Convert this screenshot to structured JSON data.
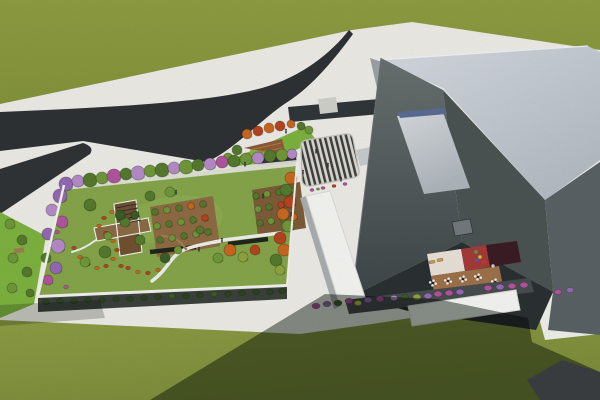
{
  "scene": {
    "type": "3d-architectural-aerial-rendering",
    "subject": "campus with rooftop garden podium, angular gray building, forked road, striped entry plaza and lawns"
  },
  "palette": {
    "ground": "#eceae5",
    "field_top": "#8d9c41",
    "field_top_dark": "#83923a",
    "field_bottom": "#96a449",
    "field_bottom_dark": "#7c8d3b",
    "road": "#2d3133",
    "road_branch": "#2f3335",
    "access_road": "#303537",
    "crossing": "#cfcfca",
    "garden_lawn": "#84a44a",
    "garden_lawn_light": "#93b156",
    "garden_rim": "#f1f1ec",
    "pergola_band": "#e6e6e0",
    "podium_wall": "#39413a",
    "orchard_ground": "#8d6a43",
    "orchard_ground2": "#7c5c38",
    "bench": "#20261c",
    "path_white": "#eceee8",
    "path_brown": "#a07b50",
    "pavilion_deck": "#8a6a45",
    "pavilion_deck_dark": "#6f5130",
    "pavilion_frame": "#f2f2ee",
    "trellis": "#2e2d2a",
    "plaza_light": "#d8d7d1",
    "plaza_dark": "#3f403c",
    "plaza_curb": "#c2c2bc",
    "lawn_strip": "#7cb13f",
    "deck_triangle": "#8a5a36",
    "deck_triangle_light": "#a87547",
    "shelter_roof": "#37373a",
    "shelter_trim": "#e8e8e6",
    "roof_light_1": "#d3d9df",
    "roof_light_2": "#b2b9c0",
    "wall_lit": "#9aa1a6",
    "wall_lit2": "#a8adaf",
    "steps": "#c6cacc",
    "tower_face_1a": "#68706f",
    "tower_face_1b": "#3e4548",
    "tower_face_2": "#4b5352",
    "tower_face_3": "#596164",
    "tower_base": "#2a2f31",
    "skylight_1": "#d5d9dd",
    "skylight_2": "#adb4ba",
    "skylight_strip": "#5a6a94",
    "vent": "#72787c",
    "white_roof": "#f3f3f0",
    "white_roof_edge": "#d9d9d5",
    "court_floor_cream": "#e7e0d6",
    "court_floor_red": "#a33a38",
    "court_play": "#3a1d24",
    "court_deck": "#9c7049",
    "lounger": "#c89a58",
    "table_seat": "#f0f0ee",
    "table_center": "#222222",
    "walk_dark": "#474c4e",
    "pavement_dark": "#3a3e40",
    "shadow": "#263129",
    "people": "#2e2e2e",
    "foliage": {
      "g1": "#3c5c26",
      "g2": "#55792e",
      "g3": "#6f9739",
      "g4": "#8ea33e",
      "dk": "#2c421f",
      "pu": "#9468b4",
      "pu2": "#b48ac6",
      "mg": "#b0549e",
      "or": "#c8661f",
      "rd": "#b6431f",
      "yl": "#b9c24a"
    }
  },
  "vegetation": {
    "garden_border": [
      [
        66,
        184,
        7,
        "pu"
      ],
      [
        78,
        181,
        6,
        "pu2"
      ],
      [
        90,
        180,
        7,
        "g2"
      ],
      [
        102,
        178,
        6,
        "g3"
      ],
      [
        114,
        176,
        7,
        "mg"
      ],
      [
        126,
        174,
        6,
        "g2"
      ],
      [
        138,
        173,
        7,
        "pu2"
      ],
      [
        150,
        171,
        6,
        "g3"
      ],
      [
        162,
        170,
        7,
        "g2"
      ],
      [
        174,
        168,
        6,
        "pu2"
      ],
      [
        186,
        167,
        7,
        "g3"
      ],
      [
        198,
        165,
        6,
        "g2"
      ],
      [
        210,
        164,
        6,
        "pu2"
      ],
      [
        222,
        162,
        6,
        "mg"
      ],
      [
        234,
        161,
        6,
        "g2"
      ],
      [
        246,
        159,
        6,
        "g3"
      ],
      [
        258,
        158,
        6,
        "pu2"
      ],
      [
        270,
        156,
        6,
        "g2"
      ],
      [
        282,
        155,
        6,
        "g3"
      ],
      [
        292,
        154,
        5,
        "pu2"
      ],
      [
        291,
        178,
        6,
        "or"
      ],
      [
        286,
        190,
        6,
        "g2"
      ],
      [
        290,
        202,
        6,
        "rd"
      ],
      [
        283,
        214,
        6,
        "or"
      ],
      [
        288,
        226,
        6,
        "g3"
      ],
      [
        280,
        238,
        6,
        "rd"
      ],
      [
        284,
        250,
        6,
        "or"
      ],
      [
        276,
        260,
        6,
        "g2"
      ],
      [
        280,
        270,
        5,
        "g4"
      ],
      [
        60,
        196,
        7,
        "pu"
      ],
      [
        52,
        210,
        6,
        "pu2"
      ],
      [
        62,
        222,
        6,
        "mg"
      ],
      [
        48,
        234,
        6,
        "pu"
      ],
      [
        58,
        246,
        7,
        "pu2"
      ],
      [
        46,
        258,
        5,
        "g2"
      ],
      [
        56,
        268,
        6,
        "pu"
      ],
      [
        48,
        280,
        5,
        "mg"
      ]
    ],
    "garden_interior": [
      [
        150,
        196,
        5,
        "g2"
      ],
      [
        170,
        192,
        5,
        "g3"
      ],
      [
        90,
        205,
        6,
        "g2"
      ],
      [
        105,
        252,
        6,
        "g2"
      ],
      [
        85,
        262,
        5,
        "g3"
      ],
      [
        120,
        215,
        5,
        "g1"
      ],
      [
        140,
        240,
        5,
        "g2"
      ],
      [
        230,
        250,
        6,
        "or"
      ],
      [
        243,
        257,
        5,
        "g4"
      ],
      [
        218,
        258,
        5,
        "g3"
      ],
      [
        255,
        250,
        5,
        "rd"
      ],
      [
        200,
        230,
        4,
        "g2"
      ],
      [
        165,
        258,
        5,
        "g1"
      ],
      [
        178,
        250,
        4,
        "g3"
      ]
    ],
    "orchard1": [
      [
        155,
        212,
        3.4,
        "g2"
      ],
      [
        167,
        210,
        3.4,
        "g3"
      ],
      [
        179,
        208,
        3.4,
        "g2"
      ],
      [
        191,
        206,
        3.4,
        "or"
      ],
      [
        203,
        204,
        3.4,
        "g2"
      ],
      [
        157,
        226,
        3.4,
        "g3"
      ],
      [
        169,
        224,
        3.4,
        "g2"
      ],
      [
        181,
        222,
        3.4,
        "g3"
      ],
      [
        193,
        220,
        3.4,
        "g2"
      ],
      [
        205,
        218,
        3.4,
        "rd"
      ],
      [
        160,
        240,
        3.4,
        "g2"
      ],
      [
        172,
        238,
        3.4,
        "g3"
      ],
      [
        184,
        236,
        3.4,
        "g2"
      ],
      [
        196,
        234,
        3.4,
        "g3"
      ],
      [
        208,
        232,
        3.4,
        "g2"
      ]
    ],
    "orchard2": [
      [
        256,
        196,
        3.3,
        "g2"
      ],
      [
        267,
        194,
        3.3,
        "g3"
      ],
      [
        279,
        192,
        3.3,
        "g2"
      ],
      [
        290,
        190,
        3.3,
        "g3"
      ],
      [
        258,
        209,
        3.3,
        "g3"
      ],
      [
        269,
        207,
        3.3,
        "g2"
      ],
      [
        281,
        205,
        3.3,
        "rd"
      ],
      [
        292,
        203,
        3.3,
        "g2"
      ],
      [
        260,
        223,
        3.3,
        "g2"
      ],
      [
        271,
        221,
        3.3,
        "g3"
      ],
      [
        283,
        219,
        3.3,
        "g2"
      ],
      [
        294,
        217,
        3.3,
        "or"
      ]
    ],
    "street_trees": [
      [
        10,
        224,
        5,
        "g3"
      ],
      [
        22,
        240,
        5,
        "g2"
      ],
      [
        13,
        258,
        5,
        "g3"
      ],
      [
        27,
        272,
        5,
        "g2"
      ],
      [
        12,
        288,
        5,
        "g3"
      ],
      [
        30,
        293,
        4,
        "g2"
      ]
    ],
    "orange_row": [
      [
        247,
        134,
        5,
        "or"
      ],
      [
        258,
        131,
        5,
        "rd"
      ],
      [
        269,
        128,
        5,
        "or"
      ],
      [
        280,
        126,
        5,
        "rd"
      ],
      [
        291,
        124,
        4,
        "or"
      ],
      [
        301,
        126,
        4,
        "g2"
      ],
      [
        309,
        130,
        4,
        "g3"
      ],
      [
        237,
        150,
        5,
        "g2"
      ],
      [
        228,
        158,
        5,
        "g3"
      ]
    ],
    "hedge": [
      [
        46,
        302,
        3.4,
        "dk"
      ],
      [
        60,
        301,
        3.4,
        "dk"
      ],
      [
        74,
        301,
        3.4,
        "dk"
      ],
      [
        88,
        300,
        3.4,
        "dk"
      ],
      [
        102,
        300,
        3.4,
        "dk"
      ],
      [
        116,
        299,
        3.4,
        "dk"
      ],
      [
        130,
        299,
        3.4,
        "dk"
      ],
      [
        144,
        298,
        3.4,
        "dk"
      ],
      [
        158,
        297,
        3.4,
        "dk"
      ],
      [
        172,
        296,
        3.4,
        "g1"
      ],
      [
        186,
        296,
        3.4,
        "dk"
      ],
      [
        200,
        295,
        3.4,
        "dk"
      ],
      [
        214,
        294,
        3.4,
        "g1"
      ],
      [
        228,
        294,
        3.4,
        "dk"
      ],
      [
        242,
        293,
        3.4,
        "dk"
      ],
      [
        256,
        292,
        3.4,
        "dk"
      ],
      [
        270,
        292,
        3.4,
        "dk"
      ],
      [
        282,
        291,
        3.4,
        "dk"
      ]
    ],
    "flower_red": [
      [
        74,
        248,
        2.4,
        "rd"
      ],
      [
        80,
        257,
        2.4,
        "or"
      ],
      [
        88,
        264,
        2.4,
        "rd"
      ],
      [
        97,
        268,
        2.4,
        "or"
      ],
      [
        106,
        266,
        2.4,
        "rd"
      ],
      [
        113,
        259,
        2.4,
        "or"
      ],
      [
        117,
        250,
        2.4,
        "rd"
      ],
      [
        113,
        241,
        2.4,
        "or"
      ],
      [
        106,
        233,
        2.4,
        "rd"
      ],
      [
        99,
        226,
        2.4,
        "or"
      ],
      [
        104,
        218,
        2.4,
        "rd"
      ],
      [
        112,
        212,
        2.4,
        "or"
      ],
      [
        128,
        268,
        2.4,
        "rd"
      ],
      [
        138,
        272,
        2.4,
        "or"
      ],
      [
        148,
        273,
        2.4,
        "rd"
      ],
      [
        158,
        270,
        2.4,
        "or"
      ],
      [
        121,
        266,
        2.4,
        "rd"
      ]
    ],
    "tulips": [
      [
        57,
        232,
        2.5,
        "mg"
      ],
      [
        52,
        246,
        2.5,
        "mg"
      ],
      [
        66,
        287,
        2.5,
        "mg"
      ]
    ],
    "plaza_beds": [
      [
        312,
        190,
        2,
        "mg"
      ],
      [
        323,
        188,
        2,
        "mg"
      ],
      [
        334,
        186,
        2,
        "rd"
      ],
      [
        345,
        184,
        2,
        "mg"
      ],
      [
        318,
        189,
        1.6,
        "g3"
      ]
    ],
    "frontage_bushes": [
      [
        316,
        306,
        4,
        "mg"
      ],
      [
        327,
        304,
        4,
        "pu"
      ],
      [
        338,
        303,
        4,
        "g1"
      ],
      [
        349,
        301,
        4,
        "mg"
      ],
      [
        358,
        303,
        3.6,
        "yl"
      ],
      [
        368,
        300,
        4,
        "pu"
      ],
      [
        380,
        299,
        4,
        "mg"
      ],
      [
        394,
        298,
        3.6,
        "pu2"
      ],
      [
        405,
        297,
        3.6,
        "g1"
      ],
      [
        417,
        297,
        4,
        "g4"
      ],
      [
        428,
        296,
        4,
        "pu"
      ],
      [
        438,
        294,
        4,
        "mg"
      ],
      [
        449,
        293,
        4,
        "mg"
      ],
      [
        460,
        292,
        4,
        "pu"
      ],
      [
        488,
        288,
        4,
        "mg"
      ],
      [
        500,
        287,
        4,
        "pu"
      ],
      [
        512,
        286,
        4,
        "mg"
      ],
      [
        524,
        285,
        4,
        "mg"
      ],
      [
        558,
        292,
        3.6,
        "mg"
      ],
      [
        570,
        290,
        3.6,
        "pu"
      ]
    ],
    "pavilion_trees": [
      [
        125,
        222,
        5,
        "g2"
      ],
      [
        135,
        215,
        4,
        "g1"
      ],
      [
        108,
        236,
        4,
        "g3"
      ]
    ]
  },
  "benches": [
    [
      150,
      252,
      196,
      247
    ],
    [
      228,
      244,
      268,
      239
    ]
  ],
  "court": {
    "tables": [
      [
        433,
        283
      ],
      [
        448,
        281
      ],
      [
        463,
        279
      ],
      [
        478,
        277
      ],
      [
        495,
        282
      ]
    ],
    "loungers": [
      [
        432,
        262
      ],
      [
        440,
        260
      ]
    ],
    "play_items": [
      [
        476,
        252,
        "#3fae3f"
      ],
      [
        480,
        257,
        "#d8c63c"
      ],
      [
        484,
        262,
        "#c23a30"
      ],
      [
        477,
        260,
        "#3a62c2"
      ],
      [
        493,
        266,
        "#cccccc"
      ]
    ]
  },
  "people": [
    [
      316,
      152
    ],
    [
      328,
      166
    ],
    [
      303,
      173
    ],
    [
      291,
      215
    ],
    [
      263,
      197
    ],
    [
      222,
      241
    ],
    [
      199,
      250
    ],
    [
      176,
      193
    ],
    [
      286,
      132
    ],
    [
      341,
      180
    ],
    [
      245,
      165
    ]
  ]
}
